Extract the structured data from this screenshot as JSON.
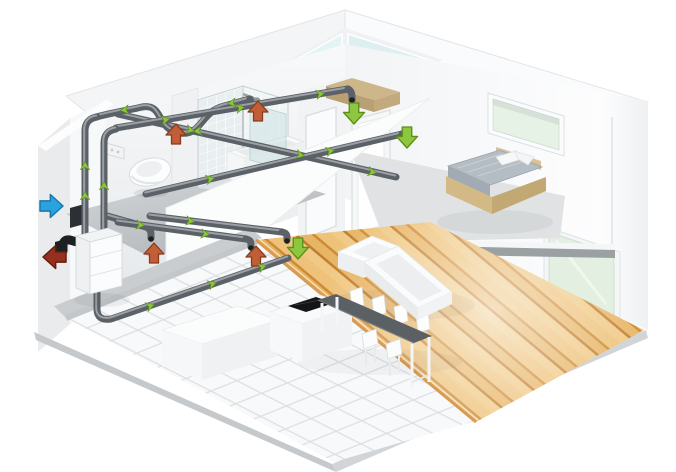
{
  "meta": {
    "type": "isometric-cutaway-illustration",
    "subject": "two-storey house with whole-house heat-recovery ventilation system",
    "background": "#ffffff"
  },
  "colors": {
    "supply_green": "#8dc63f",
    "supply_green_dark": "#5d8f18",
    "extract_orange": "#c25e36",
    "extract_orange_dark": "#8a3a1c",
    "fresh_air_blue": "#29a3dd",
    "fresh_air_blue_dark": "#1878ab",
    "exhaust_red": "#94301d",
    "exhaust_red_dark": "#641d0e",
    "duct": "#5b6166",
    "duct_light": "#aab0b5",
    "black_part": "#1d2023",
    "wall": "#f5f6f7",
    "wall_shadow": "#e3e6e8",
    "floor_gray": "#ccd0d2",
    "tile": "#f8f9fa",
    "tile_line": "#dde0e2",
    "wood_light": "#f0c985",
    "wood_mid": "#e2ad5c",
    "wood_dark": "#c8863a",
    "glass_sky": "#e4f3f4",
    "glass_green": "#e7f2e6",
    "slab_edge": "#9aa0a3",
    "unit_body": "#eef0f1",
    "table_top": "#5b6064",
    "bed_mattress": "#b4bcc4",
    "bed_frame": "#d5bd8c",
    "cooktop": "#131517"
  },
  "ventilation": {
    "unit_name": "heat-recovery-ventilation-unit",
    "airflow_arrows": [
      {
        "id": "fresh-air-intake",
        "role": "intake",
        "dir": "right",
        "x": 63,
        "y": 206,
        "s": 1.15,
        "color": "fresh_air_blue",
        "edge": "fresh_air_blue_dark"
      },
      {
        "id": "exhaust-air-outlet",
        "role": "exhaust",
        "dir": "left",
        "x": 43,
        "y": 257,
        "s": 1.15,
        "color": "exhaust_red",
        "edge": "exhaust_red_dark"
      },
      {
        "id": "extract-toilet",
        "role": "extract",
        "dir": "up",
        "x": 176,
        "y": 124,
        "s": 1,
        "color": "extract_orange",
        "edge": "extract_orange_dark"
      },
      {
        "id": "extract-shower",
        "role": "extract",
        "dir": "up",
        "x": 258,
        "y": 101,
        "s": 1,
        "color": "extract_orange",
        "edge": "extract_orange_dark"
      },
      {
        "id": "extract-utility",
        "role": "extract",
        "dir": "up",
        "x": 154,
        "y": 243,
        "s": 1,
        "color": "extract_orange",
        "edge": "extract_orange_dark"
      },
      {
        "id": "extract-kitchen",
        "role": "extract",
        "dir": "up",
        "x": 256,
        "y": 246,
        "s": 1,
        "color": "extract_orange",
        "edge": "extract_orange_dark"
      },
      {
        "id": "supply-bedroom",
        "role": "supply",
        "dir": "down",
        "x": 354,
        "y": 124,
        "s": 1.05,
        "color": "supply_green",
        "edge": "supply_green_dark"
      },
      {
        "id": "supply-hallway",
        "role": "supply",
        "dir": "down",
        "x": 407,
        "y": 148,
        "s": 1.05,
        "color": "supply_green",
        "edge": "supply_green_dark"
      },
      {
        "id": "supply-living-room",
        "role": "supply",
        "dir": "down",
        "x": 298,
        "y": 259,
        "s": 1.05,
        "color": "supply_green",
        "edge": "supply_green_dark"
      }
    ],
    "flow_markers": [
      {
        "x": 125,
        "y": 110,
        "a": 263
      },
      {
        "x": 198,
        "y": 131,
        "a": 263
      },
      {
        "x": 232,
        "y": 103,
        "a": 263
      },
      {
        "x": 165,
        "y": 120,
        "a": 80
      },
      {
        "x": 240,
        "y": 108,
        "a": 80
      },
      {
        "x": 320,
        "y": 94,
        "a": 80
      },
      {
        "x": 190,
        "y": 130,
        "a": 103
      },
      {
        "x": 300,
        "y": 155,
        "a": 103
      },
      {
        "x": 372,
        "y": 172,
        "a": 103
      },
      {
        "x": 210,
        "y": 179,
        "a": 77
      },
      {
        "x": 330,
        "y": 151,
        "a": 77
      },
      {
        "x": 140,
        "y": 225,
        "a": 98
      },
      {
        "x": 205,
        "y": 234,
        "a": 98
      },
      {
        "x": 190,
        "y": 221,
        "a": 98
      },
      {
        "x": 150,
        "y": 306,
        "a": 71
      },
      {
        "x": 212,
        "y": 284,
        "a": 71
      },
      {
        "x": 262,
        "y": 267,
        "a": 71
      },
      {
        "x": 85,
        "y": 196,
        "a": 0
      },
      {
        "x": 85,
        "y": 166,
        "a": 0
      },
      {
        "x": 104,
        "y": 186,
        "a": 0
      }
    ]
  },
  "rooms": [
    {
      "name": "bathroom",
      "level": "upper"
    },
    {
      "name": "bedroom",
      "level": "upper"
    },
    {
      "name": "hallway",
      "level": "upper"
    },
    {
      "name": "living-room",
      "level": "lower"
    },
    {
      "name": "kitchen-dining",
      "level": "lower"
    }
  ],
  "furniture": [
    "shower-enclosure",
    "wall-hung-toilet",
    "flush-plate",
    "bathtub",
    "glass-screen",
    "double-bed",
    "wardrobe",
    "sectional-sofa",
    "dining-table",
    "dining-chairs",
    "kitchen-island",
    "induction-cooktop",
    "kitchen-counter"
  ],
  "openings": [
    "roof-skylight",
    "bedroom-window",
    "living-room-glazing"
  ]
}
